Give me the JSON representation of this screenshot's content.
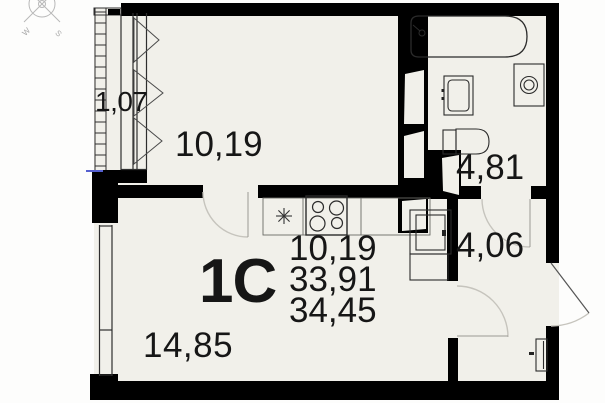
{
  "plan": {
    "type_label": "1C",
    "area_summary": {
      "line1": "10,19",
      "line2": "33,91",
      "line3": "34,45"
    },
    "rooms": {
      "balcony": "1,07",
      "room": "10,19",
      "bathroom": "4,81",
      "hallway": "4,06",
      "living": "14,85"
    },
    "compass": {
      "west": "W",
      "south": "S"
    },
    "colors": {
      "wall": "#000000",
      "floor": "#f1f0ea",
      "fixture_line": "#2b2b2b",
      "door_arc": "#c6c4bd",
      "window_mark_blue": "#5560d0",
      "compass": "#b8b8b8"
    }
  }
}
